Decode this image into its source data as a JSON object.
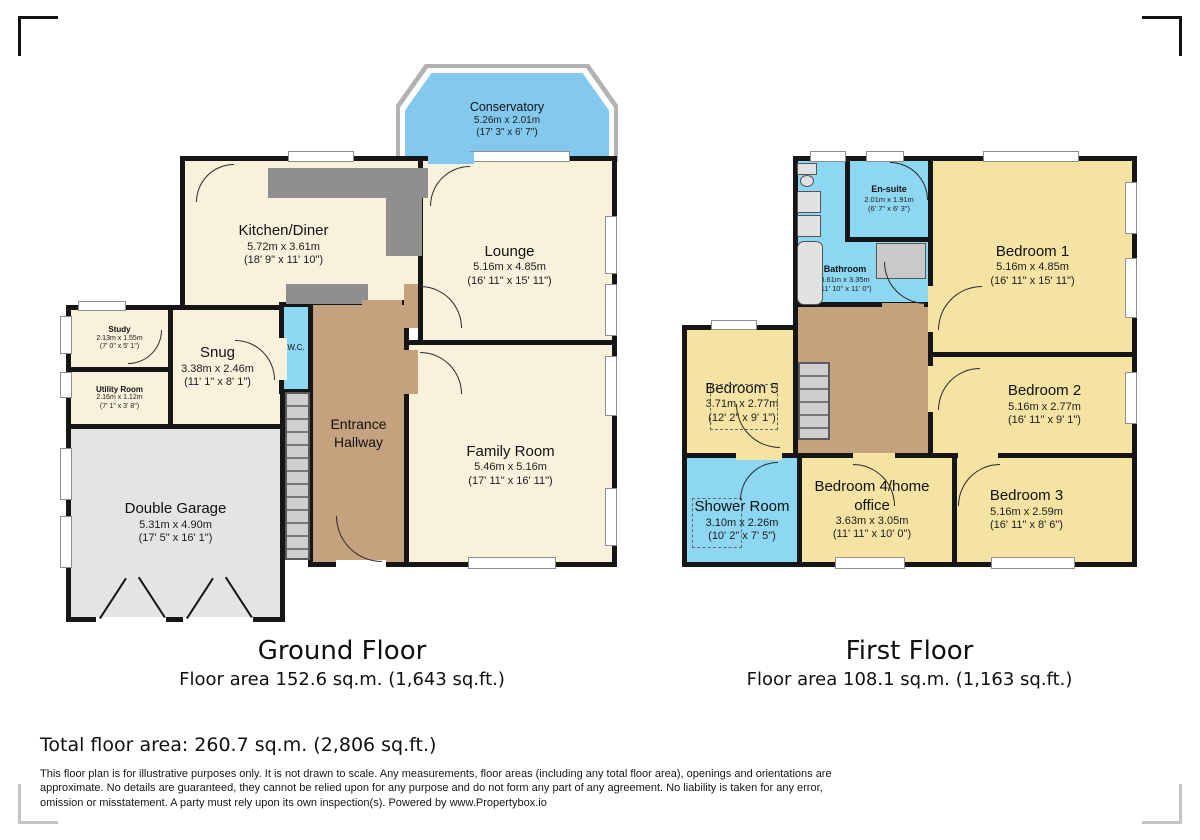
{
  "ground_floor": {
    "title": "Ground Floor",
    "area_label": "Floor area 152.6 sq.m. (1,643 sq.ft.)",
    "rooms": {
      "conservatory": {
        "name": "Conservatory",
        "metric": "5.26m x 2.01m",
        "imperial": "(17' 3\" x 6' 7\")"
      },
      "kitchen": {
        "name": "Kitchen/Diner",
        "metric": "5.72m x 3.61m",
        "imperial": "(18' 9\" x 11' 10\")"
      },
      "lounge": {
        "name": "Lounge",
        "metric": "5.16m x 4.85m",
        "imperial": "(16' 11\" x 15' 11\")"
      },
      "study": {
        "name": "Study",
        "metric": "2.13m x 1.55m",
        "imperial": "(7' 0\" x 5' 1\")"
      },
      "snug": {
        "name": "Snug",
        "metric": "3.38m x 2.46m",
        "imperial": "(11' 1\" x 8' 1\")"
      },
      "utility": {
        "name": "Utility Room",
        "metric": "2.16m x 1.12m",
        "imperial": "(7' 1\" x 3' 8\")"
      },
      "wc": {
        "name": "W.C."
      },
      "hallway": {
        "name": "Entrance Hallway"
      },
      "family": {
        "name": "Family Room",
        "metric": "5.46m x 5.16m",
        "imperial": "(17' 11\" x 16' 11\")"
      },
      "garage": {
        "name": "Double Garage",
        "metric": "5.31m x 4.90m",
        "imperial": "(17' 5\" x 16' 1\")"
      }
    }
  },
  "first_floor": {
    "title": "First Floor",
    "area_label": "Floor area 108.1 sq.m. (1,163 sq.ft.)",
    "rooms": {
      "ensuite": {
        "name": "En-suite",
        "metric": "2.01m x 1.91m",
        "imperial": "(6' 7\" x 6' 3\")"
      },
      "bathroom": {
        "name": "Bathroom",
        "metric": "3.61m x 3.35m",
        "imperial": "(11' 10\" x 11' 0\")"
      },
      "bedroom1": {
        "name": "Bedroom 1",
        "metric": "5.16m x 4.85m",
        "imperial": "(16' 11\" x 15' 11\")"
      },
      "bedroom5": {
        "name": "Bedroom 5",
        "metric": "3.71m x 2.77m",
        "imperial": "(12' 2\" x 9' 1\")"
      },
      "bedroom2": {
        "name": "Bedroom 2",
        "metric": "5.16m x 2.77m",
        "imperial": "(16' 11\" x 9' 1\")"
      },
      "shower": {
        "name": "Shower Room",
        "metric": "3.10m x 2.26m",
        "imperial": "(10' 2\" x 7' 5\")"
      },
      "bedroom4": {
        "name": "Bedroom 4/home office",
        "metric": "3.63m x 3.05m",
        "imperial": "(11' 11\" x 10' 0\")"
      },
      "bedroom3": {
        "name": "Bedroom 3",
        "metric": "5.16m x 2.59m",
        "imperial": "(16' 11\" x 8' 6\")"
      }
    }
  },
  "footer": {
    "total_area": "Total floor area: 260.7 sq.m. (2,806 sq.ft.)",
    "disclaimer": "This floor plan is for illustrative purposes only. It is not drawn to scale. Any measurements, floor areas (including any total floor area), openings and orientations are approximate. No details are guaranteed, they cannot be relied upon for any purpose and do not form any part of any agreement. No liability is taken for any error, omission or misstatement. A party must rely upon its own inspection(s). Powered by www.Propertybox.io"
  },
  "colors": {
    "wall": "#161616",
    "room_cream": "#f8f2dc",
    "room_yellow": "#f4e3a3",
    "room_wet_blue": "#8ed7f2",
    "hallway_brown": "#c3a27d",
    "garage_gray": "#e4e4e4"
  }
}
